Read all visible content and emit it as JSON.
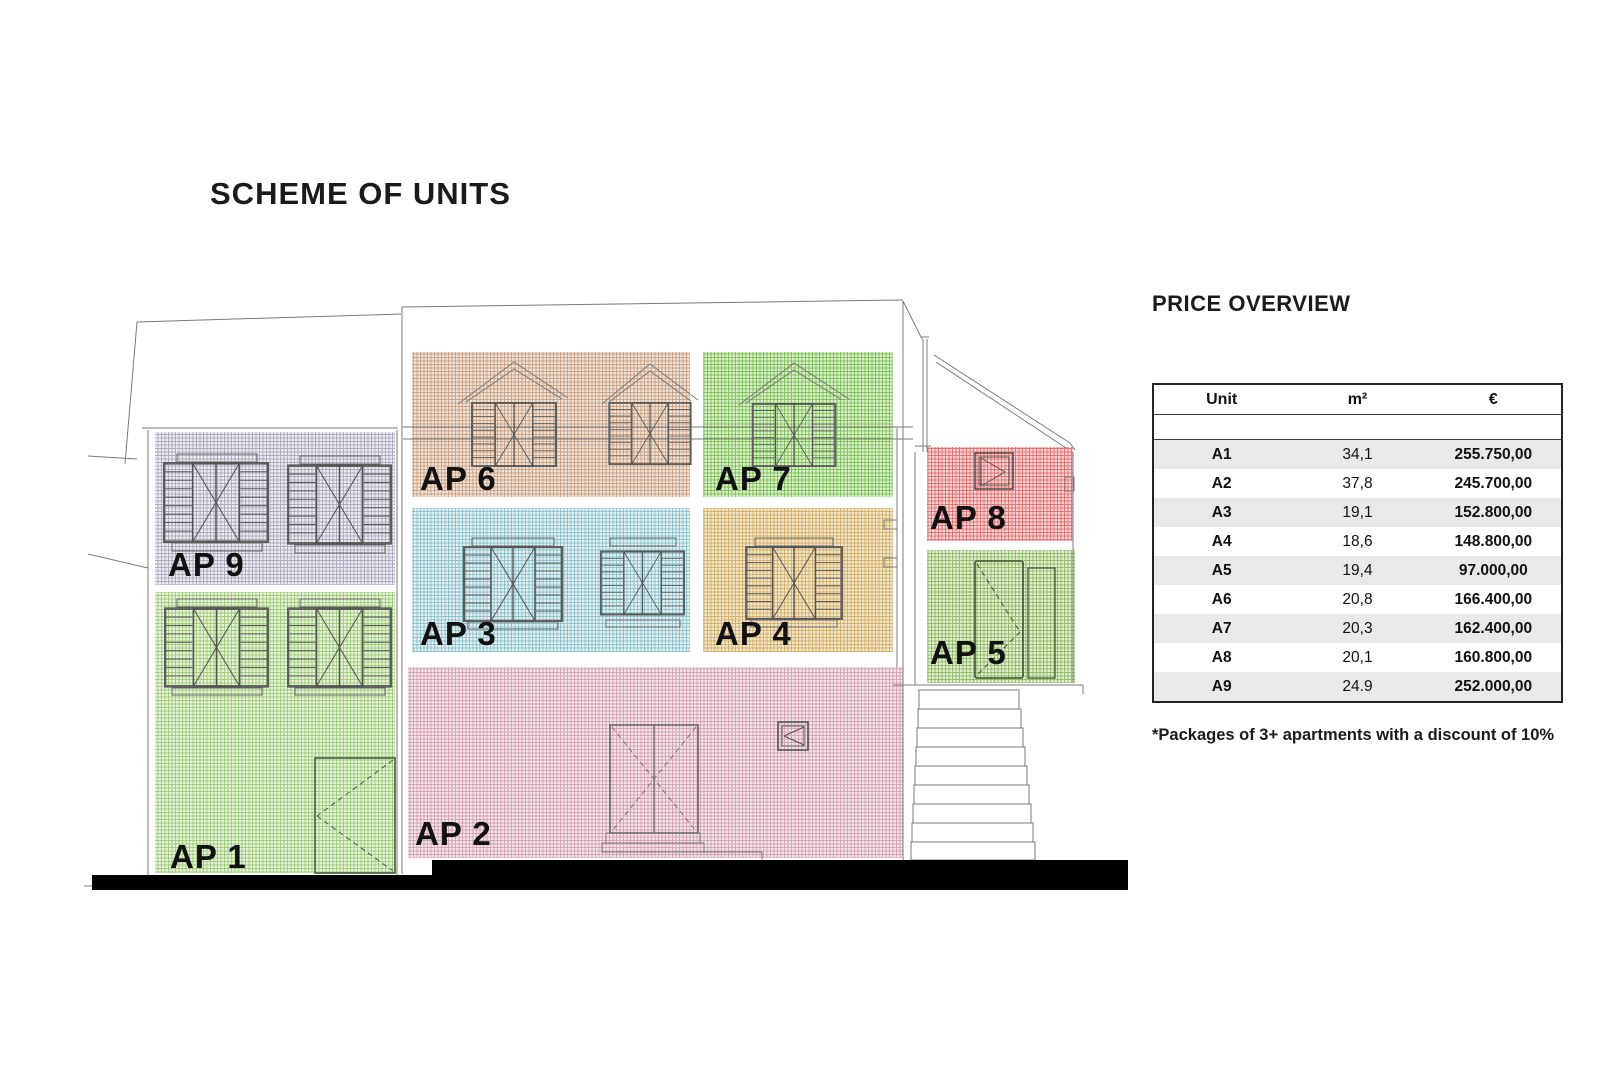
{
  "title": "SCHEME OF UNITS",
  "price_overview": {
    "heading": "PRICE OVERVIEW",
    "columns": [
      "Unit",
      "m²",
      "€"
    ],
    "rows": [
      {
        "unit": "A1",
        "area": "34,1",
        "price": "255.750,00"
      },
      {
        "unit": "A2",
        "area": "37,8",
        "price": "245.700,00"
      },
      {
        "unit": "A3",
        "area": "19,1",
        "price": "152.800,00"
      },
      {
        "unit": "A4",
        "area": "18,6",
        "price": "148.800,00"
      },
      {
        "unit": "A5",
        "area": "19,4",
        "price": "97.000,00"
      },
      {
        "unit": "A6",
        "area": "20,8",
        "price": "166.400,00"
      },
      {
        "unit": "A7",
        "area": "20,3",
        "price": "162.400,00"
      },
      {
        "unit": "A8",
        "area": "20,1",
        "price": "160.800,00"
      },
      {
        "unit": "A9",
        "area": "24.9",
        "price": "252.000,00"
      }
    ],
    "footnote": "*Packages of 3+ apartments with a discount of 10%"
  },
  "scheme": {
    "units": [
      {
        "id": "ap1",
        "label": "AP 1",
        "base": "#e7f3d8",
        "line": "#96c56e"
      },
      {
        "id": "ap2",
        "label": "AP 2",
        "base": "#f4e3e8",
        "line": "#cf9aaa"
      },
      {
        "id": "ap3",
        "label": "AP 3",
        "base": "#e2f0f2",
        "line": "#82bcc6"
      },
      {
        "id": "ap4",
        "label": "AP 4",
        "base": "#f2e6c8",
        "line": "#cfa95e"
      },
      {
        "id": "ap5",
        "label": "AP 5",
        "base": "#e2eecd",
        "line": "#86b25c"
      },
      {
        "id": "ap6",
        "label": "AP 6",
        "base": "#f0e2d4",
        "line": "#c39a7e"
      },
      {
        "id": "ap7",
        "label": "AP 7",
        "base": "#daf0c8",
        "line": "#74b94e"
      },
      {
        "id": "ap8",
        "label": "AP 8",
        "base": "#f6d6d4",
        "line": "#e26060"
      },
      {
        "id": "ap9",
        "label": "AP 9",
        "base": "#ebebf1",
        "line": "#a2a2b4"
      }
    ]
  },
  "colors": {
    "outline": "#777777",
    "ground": "#000000",
    "table_stripe": "#e9e9e9"
  }
}
